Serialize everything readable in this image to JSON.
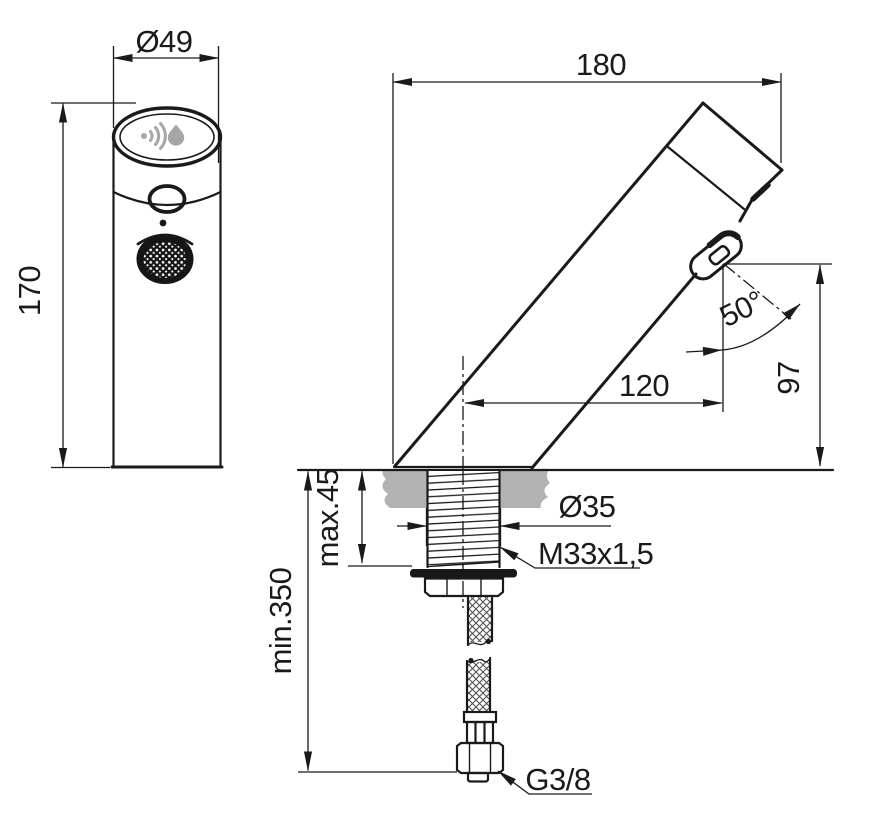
{
  "drawing": {
    "type": "technical-dimension-drawing",
    "subject": "sensor basin tap, front view and side section view with installation parts",
    "colors": {
      "line": "#1a1a1a",
      "deck_gray": "#b2b2b2",
      "icon_gray": "#a6a6a6",
      "background": "#ffffff"
    },
    "dimensions": {
      "top_diameter": "Ø49",
      "body_height": "170",
      "total_depth": "180",
      "spout_angle": "50°",
      "outlet_height": "97",
      "spout_reach": "120",
      "max_deck_thickness": "max.45",
      "hole_diameter": "Ø35",
      "shank_thread": "M33x1,5",
      "min_clearance": "min.350",
      "supply_connection": "G3/8"
    },
    "icons": {
      "sensor_waves": "proximity-sensor-waves-icon",
      "water_drop": "water-drop-icon"
    }
  }
}
